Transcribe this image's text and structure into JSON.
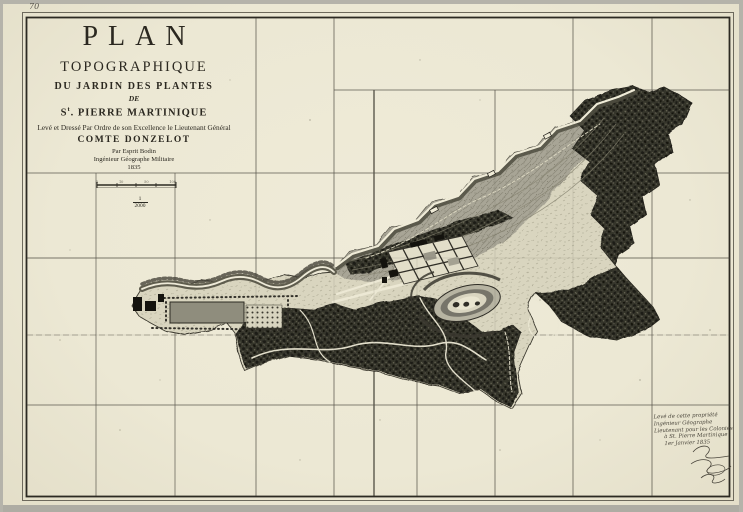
{
  "sheet": {
    "paper_color": "#ece8d4",
    "frame_ink": "#2c2a22",
    "corner_annotation": "70"
  },
  "title_block": {
    "plan": "PLAN",
    "topographique": "TOPOGRAPHIQUE",
    "du_jardin": "DU JARDIN DES PLANTES",
    "de": "DE",
    "place_prefix": "S",
    "place_sup": "t",
    "place_rest": ". PIERRE MARTINIQUE",
    "dedication": "Levé et Dressé Par Ordre de son Excellence le Lieutenant Général",
    "comte": "COMTE DONZELOT",
    "par_ligne": "Par Esprit Bodin",
    "ingenieur": "Ingénieur Géographe Militaire",
    "year": "1835"
  },
  "scale": {
    "numerator": "1",
    "denominator": "2000",
    "tick_labels": [
      "5",
      "10",
      "50",
      "100"
    ]
  },
  "handwritten_note": {
    "lines": [
      "Levé de cette propriété",
      "Ingénieur Géographe",
      "Lieutenant pour les Colonies",
      "à St. Pierre Martinique",
      "1er Janvier 1835"
    ]
  },
  "colors": {
    "valley_gray": "#a8a596",
    "forest_dark": "#34332b",
    "river_white": "#f0ecd8",
    "grid_ink": "#45423a"
  }
}
